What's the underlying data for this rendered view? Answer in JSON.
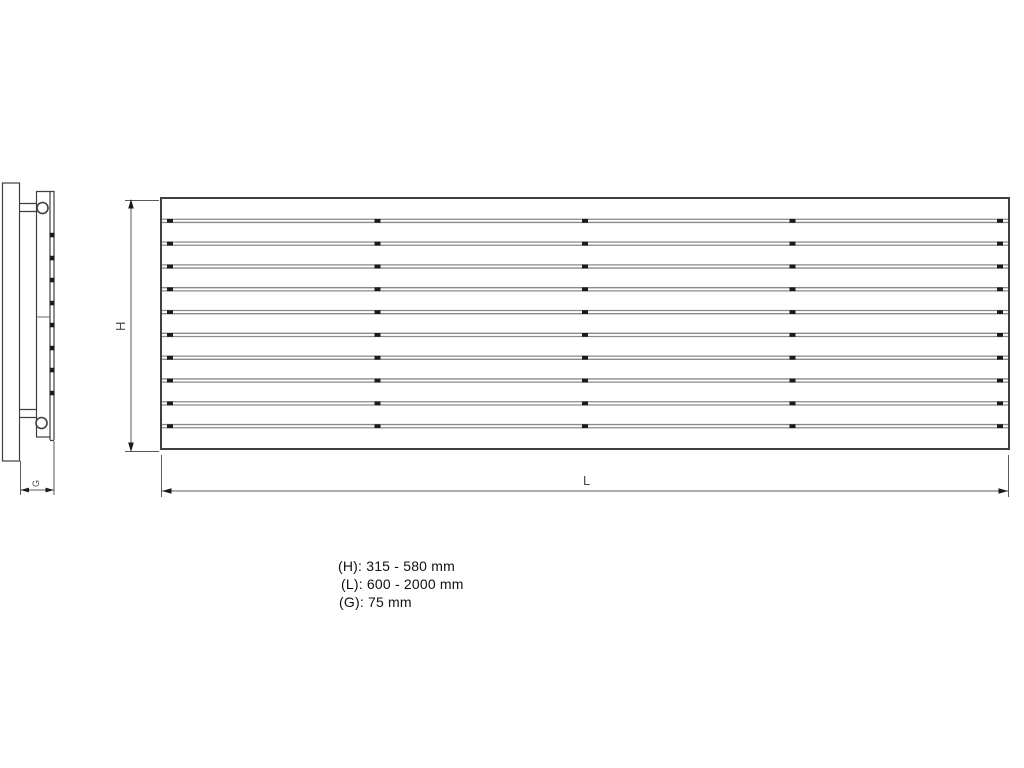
{
  "diagram": {
    "title": "horizontal-panel-radiator-dimension-drawing",
    "front_view": {
      "height_dim_label": "H",
      "length_dim_label": "L",
      "slat_gap_count": 10,
      "weld_tick_positions_x": [
        170,
        377.5,
        585,
        792.5,
        1000
      ]
    },
    "side_view": {
      "depth_dim_label": "G",
      "slat_tab_positions_y": [
        235,
        258,
        280,
        303,
        325,
        348,
        370,
        393
      ]
    },
    "specs": {
      "height_range": "(H): 315 - 580 mm",
      "length_range": "(L): 600 - 2000 mm",
      "depth": "(G): 75 mm"
    },
    "colors": {
      "line": "#3f3f3f",
      "slat_line": "#8a8a8a",
      "tick": "#1a1a1a"
    }
  }
}
